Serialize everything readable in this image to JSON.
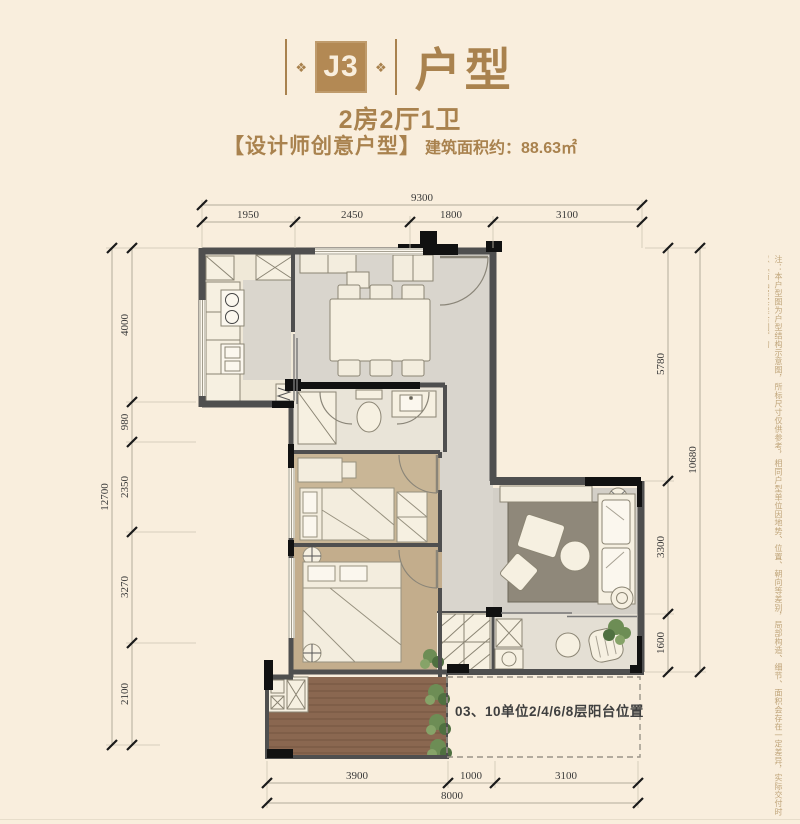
{
  "header": {
    "unit_code": "J3",
    "unit_suffix": "户型",
    "ornament_glyph": "❖",
    "layout_summary": "2房2厅1卫",
    "tagline": "【设计师创意户型】",
    "area_label": "建筑面积约：88.63㎡"
  },
  "plan": {
    "balcony_note": "03、10单位2/4/6/8层阳台位置",
    "dimensions": {
      "top_total": "9300",
      "top_segments": [
        "1950",
        "2450",
        "1800",
        "3100"
      ],
      "left_total": "12700",
      "left_segments": [
        "4000",
        "980",
        "2350",
        "3270",
        "2100"
      ],
      "right_total": "10680",
      "right_segments": [
        "5780",
        "3300",
        "1600"
      ],
      "bottom_total": "8000",
      "bottom_segments": [
        "3900",
        "1000",
        "3100"
      ]
    }
  },
  "disclaimer": "注：本户型图为户型结构示意图，所标尺寸仅供参考，相同户型单位因地势、位置、朝向等差别，局部构造、细节、面积会存在一定差异，实际交付时以《商品房买卖合同》约",
  "colors": {
    "background": "#f9eedd",
    "brand_brown": "#a9824e",
    "unit_box": "#b38954",
    "wall_gray": "#4f4f4f",
    "wall_black": "#111111",
    "wood_floor": "#c9b696",
    "deck_wood": "#8a6750",
    "tile_gray": "#d9d5cd"
  }
}
